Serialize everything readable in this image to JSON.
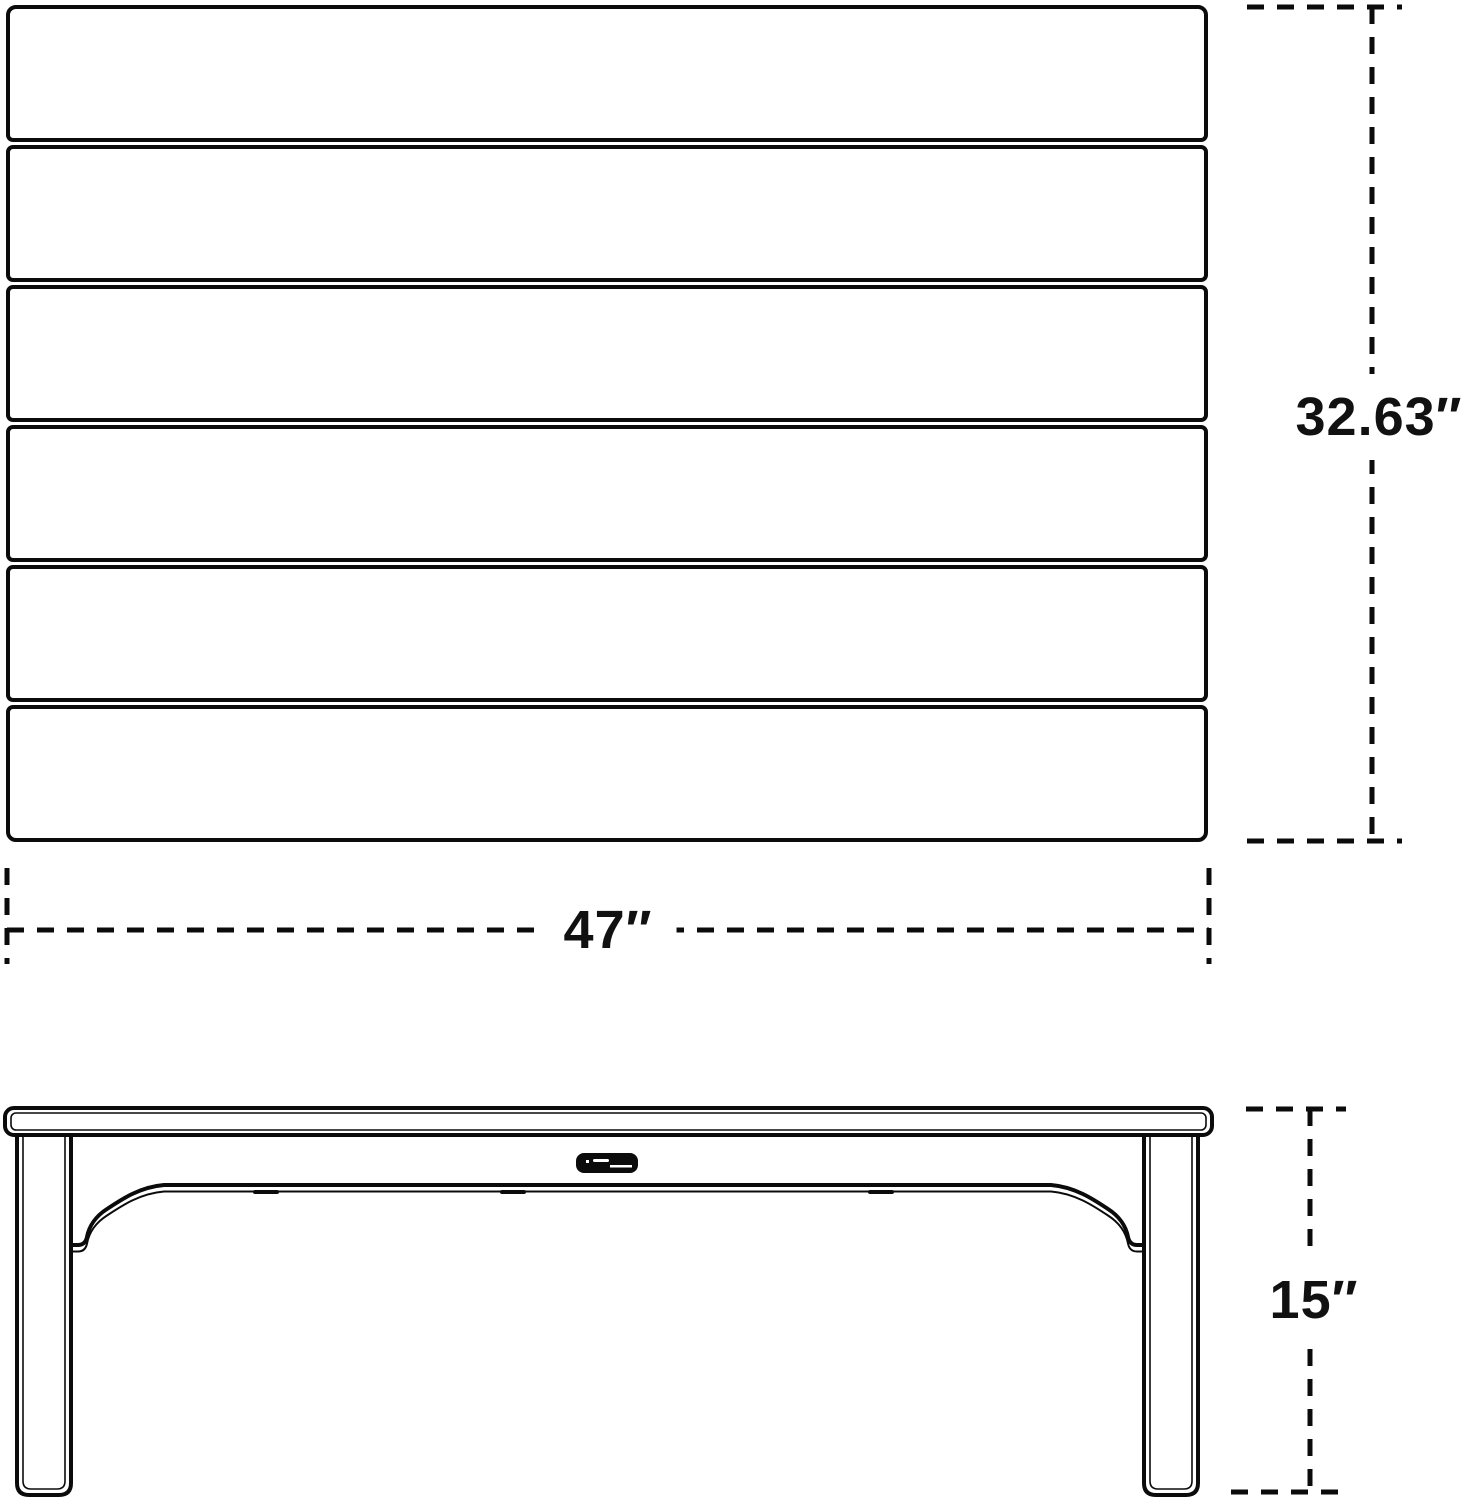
{
  "page": {
    "background": "#ffffff",
    "line_color": "#0b0b0b",
    "text_color": "#111111"
  },
  "diagram": {
    "type": "furniture-dimension-line-drawing",
    "views": {
      "top_view": {
        "name": "table top (plan) view",
        "slat_count": 6
      },
      "side_view": {
        "name": "table side elevation view",
        "badge": "brand nameplate (text illegible)"
      }
    },
    "dimensions": {
      "width": {
        "label": "47″",
        "inches": 47
      },
      "depth": {
        "label": "32.63″",
        "inches": 32.63
      },
      "height": {
        "label": "15″",
        "inches": 15
      }
    }
  }
}
